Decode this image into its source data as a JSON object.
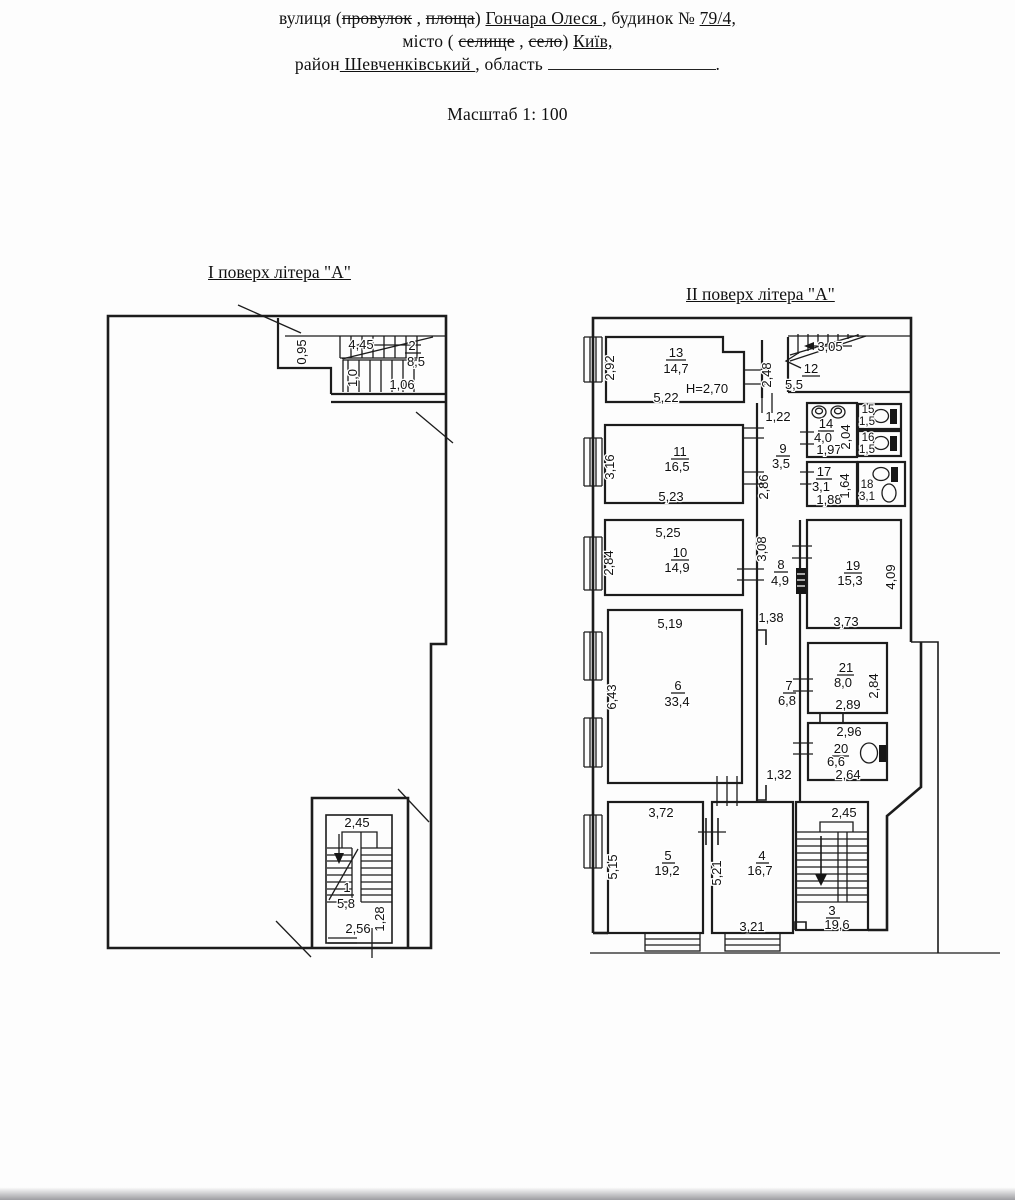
{
  "header": {
    "line1": {
      "pre": "вулиця (",
      "strike1": "провулок",
      "mid1": " , ",
      "strike2": "площа",
      "mid2": ")  ",
      "street": " Гончара Олеся ",
      "mid3": ", будинок № ",
      "house": "79/4,"
    },
    "line2": {
      "pre": "місто ( ",
      "strike1": "селище",
      "mid1": " , ",
      "strike2": "село",
      "mid2": ") ",
      "city": "Київ,"
    },
    "line3": {
      "pre": "район",
      "district": " Шевченківський ",
      "mid": " , область ",
      "end": "."
    },
    "scale": "Масштаб 1: 100"
  },
  "floor1": {
    "title": "І поверх  літера \"А\"",
    "room2": {
      "num": "2",
      "area": "8,5",
      "stair_len": "4,45",
      "niche": "0,95",
      "width": "1,06",
      "flight": "1,0"
    },
    "room1": {
      "num": "1",
      "area": "5,8",
      "top": "2,45",
      "bottom": "2,56",
      "side": "1,28"
    }
  },
  "floor2": {
    "title": "ІІ поверх  літера \"А\"",
    "room13": {
      "num": "13",
      "area": "14,7",
      "width": "5,22",
      "height": "2,92",
      "ceiling": "Н=2,70"
    },
    "corridor_top": "2,48",
    "room12": {
      "num": "12",
      "area": "5,5",
      "stair": "3,05"
    },
    "room9": {
      "num": "9",
      "area": "3,5",
      "top": "1,22",
      "height": "2,86"
    },
    "room14": {
      "num": "14",
      "area": "4,0",
      "width": "1,97",
      "height": "2,04"
    },
    "room15": {
      "num": "15",
      "area": "1,5"
    },
    "room16": {
      "num": "16",
      "area": "1,5"
    },
    "room17": {
      "num": "17",
      "area": "3,1",
      "width": "1,88",
      "height": "1,64"
    },
    "room18": {
      "num": "18",
      "area": "3,1"
    },
    "room11": {
      "num": "11",
      "area": "16,5",
      "width": "5,23",
      "height": "3,16"
    },
    "room10": {
      "num": "10",
      "area": "14,9",
      "width": "5,25",
      "height": "2,84"
    },
    "room8": {
      "num": "8",
      "area": "4,9",
      "height": "3,08",
      "bottom": "1,38"
    },
    "room19": {
      "num": "19",
      "area": "15,3",
      "width": "3,73",
      "height": "4,09"
    },
    "room6": {
      "num": "6",
      "area": "33,4",
      "width": "5,19",
      "height": "6,43"
    },
    "room7": {
      "num": "7",
      "area": "6,8",
      "bottom": "1,32"
    },
    "room21": {
      "num": "21",
      "area": "8,0",
      "width": "2,89",
      "height": "2,84"
    },
    "room20": {
      "num": "20",
      "area": "6,6",
      "top": "2,96",
      "bottom": "2,64"
    },
    "room5": {
      "num": "5",
      "area": "19,2",
      "width": "3,72",
      "height": "5,15"
    },
    "room4": {
      "num": "4",
      "area": "16,7",
      "width": "3,21",
      "height": "5,21"
    },
    "room3": {
      "num": "3",
      "area": "19,6",
      "top": "2,45"
    }
  }
}
